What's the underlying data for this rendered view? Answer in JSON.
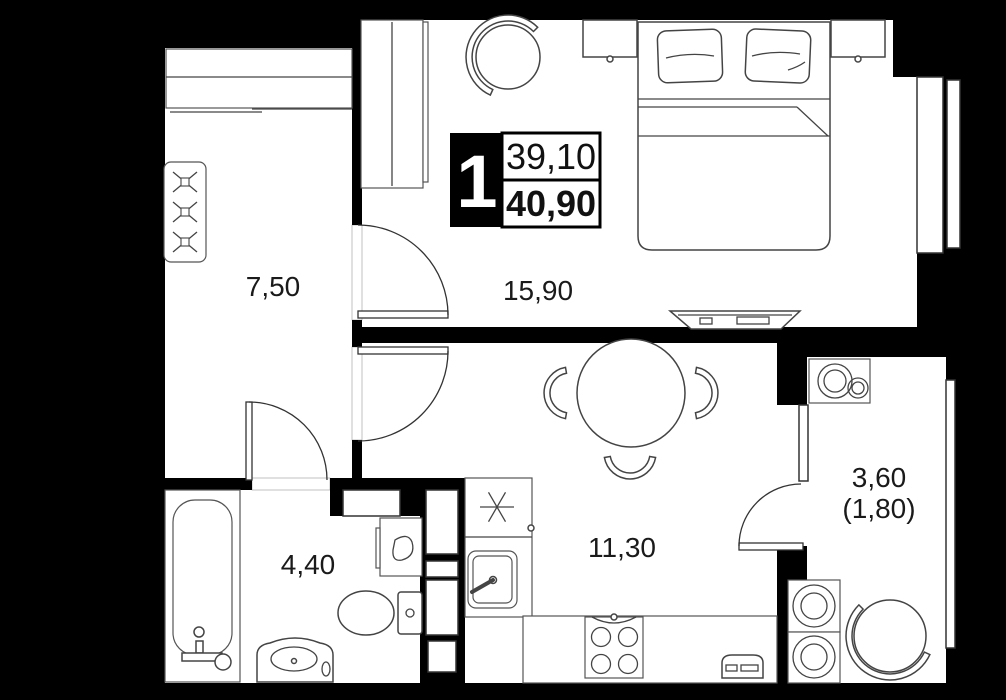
{
  "badge": {
    "room_count": "1",
    "area_living": "39,10",
    "area_total": "40,90"
  },
  "rooms": {
    "hallway": {
      "area": "7,50"
    },
    "bedroom": {
      "area": "15,90"
    },
    "bathroom": {
      "area": "4,40"
    },
    "kitchen": {
      "area": "11,30"
    },
    "balcony": {
      "area": "3,60",
      "area_reduced": "(1,80)"
    }
  },
  "colors": {
    "wall": "#000000",
    "floor": "#ffffff",
    "furniture_line": "#444444",
    "label_text": "#1a1a1a"
  },
  "furniture_icons": [
    "hall-closet-icon",
    "coat-hooks-icon",
    "wardrobe-icon",
    "armchair-icon",
    "double-bed-icon",
    "pillow-icon",
    "nightstand-icon",
    "tv-icon",
    "dining-table-icon",
    "chair-icon",
    "kitchen-counter-icon",
    "kitchen-sink-icon",
    "stove-icon",
    "radiator-icon",
    "bathtub-icon",
    "vanity-sink-icon",
    "toilet-icon",
    "bathroom-cabinet-icon",
    "laundry-sink-icon",
    "washing-machine-icon",
    "dryer-icon",
    "balcony-armchair-icon",
    "window-icon",
    "door-icon"
  ]
}
